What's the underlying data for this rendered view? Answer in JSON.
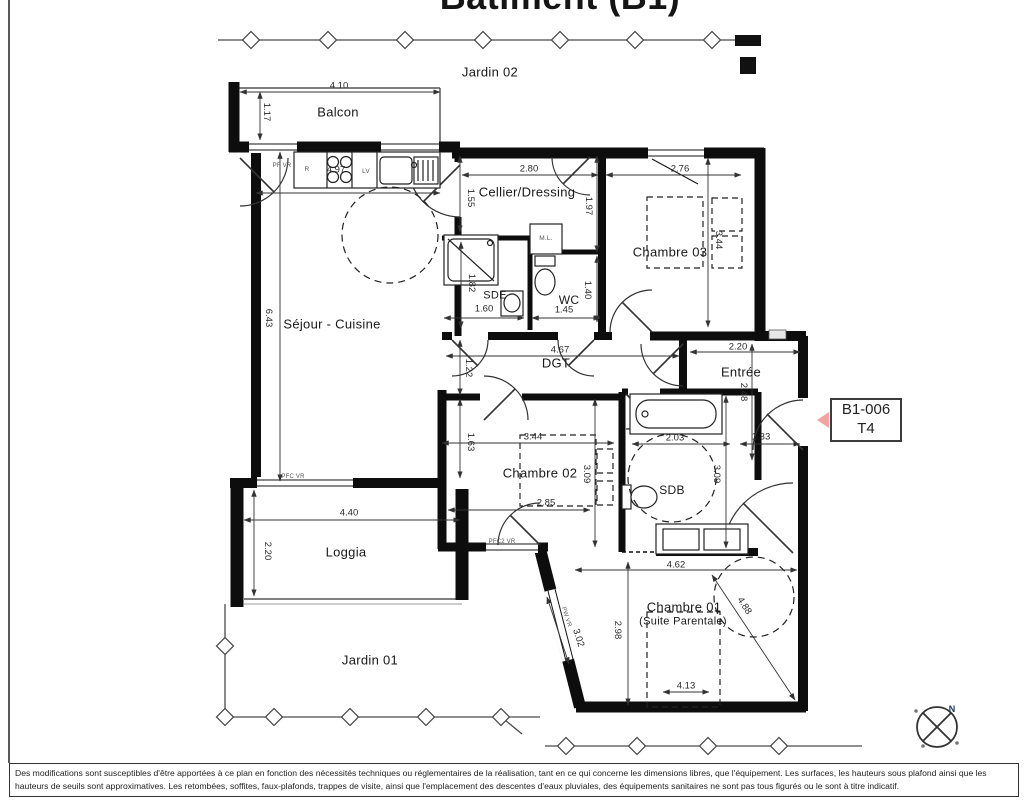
{
  "title": "Bâtiment (B1)",
  "unit_tag": {
    "code": "B1-006",
    "type": "T4",
    "arrow_color": "#f2a5a0"
  },
  "compass": {
    "north_label": "N"
  },
  "colors": {
    "wall": "#111111",
    "accent_pink": "#f2a5a0",
    "fence": "#4a4a4a"
  },
  "room_labels": [
    {
      "t": "Jardin 02",
      "x": 490,
      "y": 72
    },
    {
      "t": "Balcon",
      "x": 338,
      "y": 112
    },
    {
      "t": "Séjour - Cuisine",
      "x": 332,
      "y": 324
    },
    {
      "t": "Cellier/Dressing",
      "x": 527,
      "y": 192
    },
    {
      "t": "Chambre 03",
      "x": 670,
      "y": 252
    },
    {
      "t": "SDE",
      "x": 495,
      "y": 296,
      "s": 11
    },
    {
      "t": "WC",
      "x": 569,
      "y": 300,
      "s": 12
    },
    {
      "t": "DGT",
      "x": 556,
      "y": 363
    },
    {
      "t": "Entrée",
      "x": 741,
      "y": 372
    },
    {
      "t": "Chambre 02",
      "x": 540,
      "y": 473
    },
    {
      "t": "SDB",
      "x": 672,
      "y": 490,
      "s": 12
    },
    {
      "t": "Loggia",
      "x": 346,
      "y": 552
    },
    {
      "t": "Chambre 01",
      "x": 684,
      "y": 607
    },
    {
      "t": "(Suite Parentale)",
      "x": 683,
      "y": 622,
      "s": 11
    },
    {
      "t": "Jardin 01",
      "x": 370,
      "y": 660
    }
  ],
  "dim_labels": [
    {
      "t": "4.10",
      "x": 339,
      "y": 86
    },
    {
      "t": "1.17",
      "x": 266,
      "y": 112,
      "r": 90
    },
    {
      "t": "4.97",
      "x": 336,
      "y": 170
    },
    {
      "t": "2.80",
      "x": 529,
      "y": 169
    },
    {
      "t": "2.76",
      "x": 680,
      "y": 169
    },
    {
      "t": "1.55",
      "x": 470,
      "y": 198,
      "r": 90
    },
    {
      "t": "1.97",
      "x": 588,
      "y": 206,
      "r": 90
    },
    {
      "t": "3.44",
      "x": 718,
      "y": 240,
      "r": 90
    },
    {
      "t": "1.82",
      "x": 471,
      "y": 283,
      "r": 90
    },
    {
      "t": "1.60",
      "x": 484,
      "y": 309
    },
    {
      "t": "1.40",
      "x": 587,
      "y": 290,
      "r": 90
    },
    {
      "t": "1.45",
      "x": 564,
      "y": 310
    },
    {
      "t": "6.43",
      "x": 268,
      "y": 318,
      "r": 90
    },
    {
      "t": "4.67",
      "x": 560,
      "y": 350
    },
    {
      "t": "1.22",
      "x": 468,
      "y": 368,
      "r": 90
    },
    {
      "t": "2.20",
      "x": 738,
      "y": 347
    },
    {
      "t": "2.48",
      "x": 743,
      "y": 392,
      "r": 90
    },
    {
      "t": "1.33",
      "x": 761,
      "y": 437
    },
    {
      "t": "2.03",
      "x": 675,
      "y": 438
    },
    {
      "t": "3.44",
      "x": 533,
      "y": 437
    },
    {
      "t": "1.63",
      "x": 470,
      "y": 442,
      "r": 90
    },
    {
      "t": "3.09",
      "x": 586,
      "y": 474,
      "r": 90
    },
    {
      "t": "3.09",
      "x": 716,
      "y": 474,
      "r": 90
    },
    {
      "t": "2.85",
      "x": 546,
      "y": 503
    },
    {
      "t": "4.40",
      "x": 349,
      "y": 513
    },
    {
      "t": "2.20",
      "x": 267,
      "y": 551,
      "r": 90
    },
    {
      "t": "4.62",
      "x": 676,
      "y": 565
    },
    {
      "t": "2.98",
      "x": 617,
      "y": 630,
      "r": 90
    },
    {
      "t": "4.88",
      "x": 744,
      "y": 606,
      "r": 57
    },
    {
      "t": "3.02",
      "x": 578,
      "y": 638,
      "r": 72
    },
    {
      "t": "4.13",
      "x": 686,
      "y": 686
    }
  ],
  "annotation_labels": [
    {
      "t": "PF VR",
      "x": 282,
      "y": 166
    },
    {
      "t": "R",
      "x": 307,
      "y": 170,
      "s": 6.5
    },
    {
      "t": "LV",
      "x": 366,
      "y": 172,
      "s": 6.5
    },
    {
      "t": "M.L.",
      "x": 546,
      "y": 239,
      "s": 6.5
    },
    {
      "t": "PFC VR",
      "x": 293,
      "y": 477
    },
    {
      "t": "PFC2 VR",
      "x": 502,
      "y": 542
    },
    {
      "t": "PW VR",
      "x": 566,
      "y": 617,
      "r": 72
    }
  ],
  "disclaimer": "Des modifications sont susceptibles d'être apportées à ce plan en fonction des nécessités techniques ou réglementaires de la réalisation, tant en ce qui concerne les dimensions libres, que l'équipement. Les surfaces, les hauteurs sous plafond ainsi que les hauteurs de seuils sont approximatives. Les retombées, soffites, faux-plafonds, trappes de visite, ainsi que l'emplacement des descentes d'eaux pluviales, des équipements sanitaires ne sont pas tous figurés ou le sont à titre indicatif."
}
